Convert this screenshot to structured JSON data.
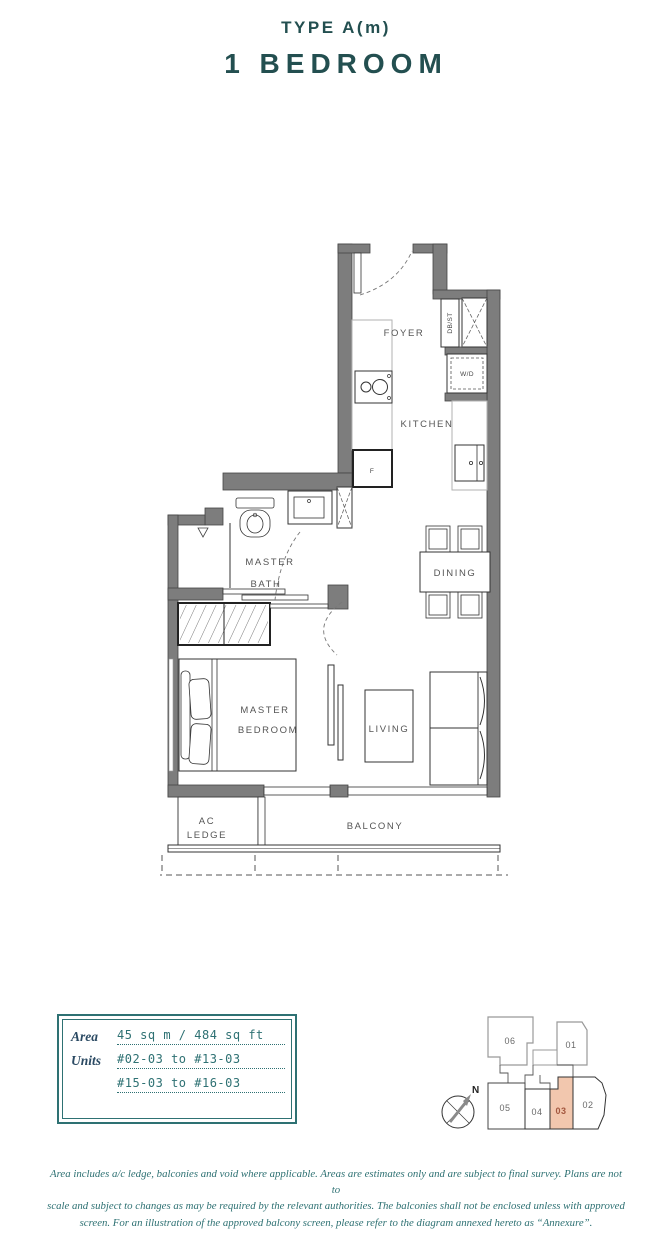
{
  "header": {
    "type_label": "TYPE A(m)",
    "title": "1 BEDROOM"
  },
  "floor_plan": {
    "labels": {
      "foyer": "FOYER",
      "kitchen": "KITCHEN",
      "master_bath_line1": "MASTER",
      "master_bath_line2": "BATH",
      "dining": "DINING",
      "master_bedroom_line1": "MASTER",
      "master_bedroom_line2": "BEDROOM",
      "living": "LIVING",
      "ac_ledge_line1": "AC",
      "ac_ledge_line2": "LEDGE",
      "balcony": "BALCONY",
      "db_st": "DB/ST",
      "washer_dryer": "W/D",
      "fridge": "F"
    }
  },
  "info_box": {
    "area_label": "Area",
    "area_value": "45 sq m / 484 sq ft",
    "units_label": "Units",
    "units_value_1": "#02-03 to #13-03",
    "units_value_2": "#15-03 to #16-03"
  },
  "key_plan": {
    "compass_label": "N",
    "highlighted_unit": "03",
    "highlight_color": "#f2c7ae",
    "units": [
      {
        "label": "06"
      },
      {
        "label": "01"
      },
      {
        "label": "05"
      },
      {
        "label": "04"
      },
      {
        "label": "03"
      },
      {
        "label": "02"
      }
    ]
  },
  "disclaimer": {
    "lines": [
      "Area includes a/c ledge, balconies and void where applicable. Areas are estimates only and are subject to final survey. Plans are not to",
      "scale and subject to changes as may be required by the relevant authorities. The balconies shall not be enclosed unless with approved",
      "screen. For an illustration of the approved balcony screen, please refer to the diagram annexed hereto as “Annexure”."
    ]
  },
  "colors": {
    "accent": "#234f50",
    "teal": "#2e7173",
    "wall_gray": "#7d7d7d"
  }
}
